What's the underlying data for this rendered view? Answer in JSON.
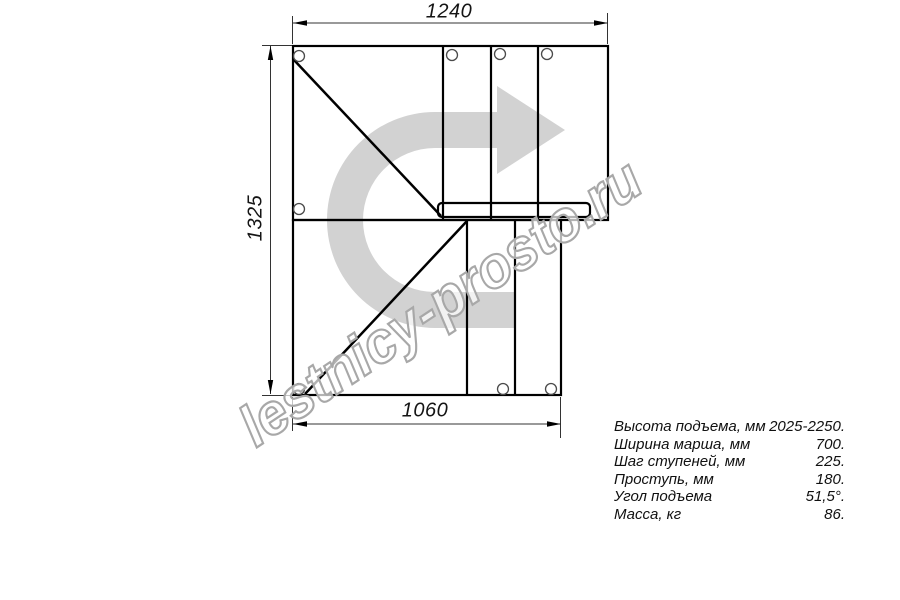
{
  "drawing": {
    "title": "stair-plan-view",
    "dimensions": {
      "top_width_mm": "1240",
      "left_height_mm": "1325",
      "bottom_width_mm": "1060"
    }
  },
  "specs": {
    "rows": [
      {
        "label": "Высота подъема, мм",
        "value": "2025-2250."
      },
      {
        "label": "Ширина марша, мм",
        "value": "700."
      },
      {
        "label": "Шаг ступеней, мм",
        "value": "225."
      },
      {
        "label": "Проступь, мм",
        "value": "180."
      },
      {
        "label": "Угол подъема",
        "value": "51,5°."
      },
      {
        "label": "Масса, кг",
        "value": "86."
      }
    ]
  },
  "watermark": {
    "text": "lestnicy-prosto.ru"
  },
  "colors": {
    "line": "#000000",
    "thin_line": "#3a3a3a",
    "watermark_arrow": "#d2d2d2",
    "watermark_outline": "#a8a8a8"
  }
}
